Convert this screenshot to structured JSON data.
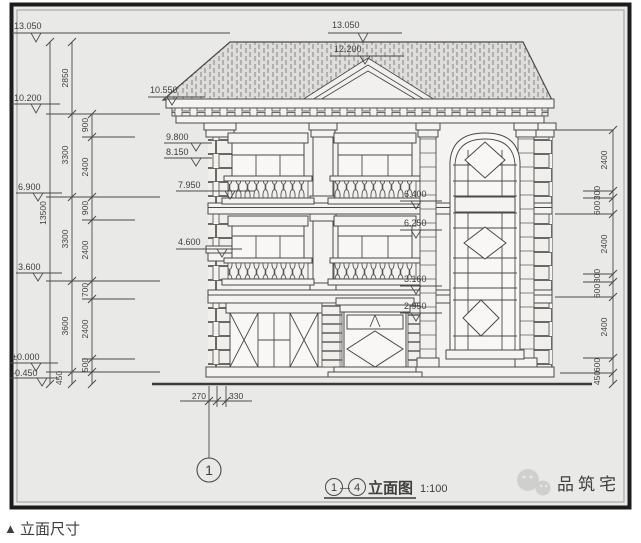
{
  "page": {
    "caption_marker": "▲",
    "caption": "立面尺寸"
  },
  "drawing": {
    "title": {
      "bubble_left": "1",
      "separator": "—",
      "bubble_right": "4",
      "name": "立面图",
      "scale": "1:100"
    },
    "axis_bubble": "1",
    "watermark": "品筑宅",
    "levels": {
      "left": [
        "13.050",
        "10.200",
        "6.900",
        "3.600",
        "±0.000",
        "-0.450"
      ],
      "roof": [
        "13.050",
        "12.200"
      ],
      "facade": [
        "10.550",
        "9.800",
        "8.150",
        "7.950",
        "4.600"
      ],
      "right_inner": [
        "6.400",
        "6.250",
        "3.160",
        "2.950"
      ]
    },
    "dims": {
      "left_total": "13500",
      "left_main": [
        "2850",
        "3300",
        "3300",
        "3600",
        "450"
      ],
      "left_sub": [
        "900",
        "2400",
        "900",
        "2400",
        "700",
        "2400",
        "500"
      ],
      "right": [
        "2400",
        "300",
        "600",
        "2400",
        "300",
        "600",
        "2400",
        "600",
        "450"
      ],
      "bottom": [
        "270",
        "330"
      ]
    }
  },
  "colors": {
    "paper": "#e9e9e7",
    "line": "#4a4a4a",
    "frame": "#1c1c1c",
    "watermark": "#cbcbc9"
  }
}
